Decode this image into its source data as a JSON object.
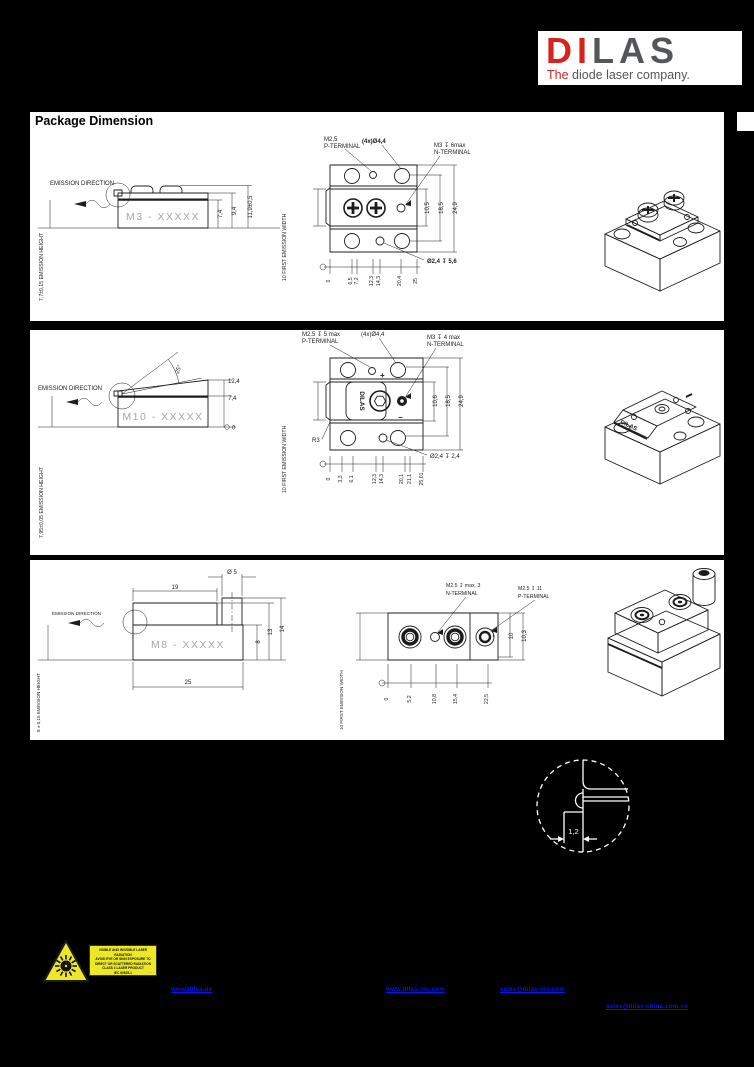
{
  "logo": {
    "di": "DI",
    "las": "LAS",
    "tagline_the": "The",
    "tagline_rest": " diode laser company."
  },
  "header": {
    "title": "Package Dimension"
  },
  "colors": {
    "brand_red": "#d8231d",
    "brand_gray": "#55565a",
    "link_blue": "#0018ea",
    "warning_yellow": "#ede827"
  },
  "panels": [
    {
      "side": {
        "emission_direction": "EMISSION DIRECTION",
        "model": "M3 - XXXXX",
        "emission_height_label": "7,7±0,15 EMISSION HEIGHT",
        "dims": [
          "7,4",
          "9,4",
          "11,9±0,5"
        ]
      },
      "top": {
        "p_terminal_line1": "M2,5",
        "p_terminal_line2": "P-TERMINAL",
        "holes_label": "(4x)Ø4,4",
        "n_terminal_line1": "M3 ↧ 6max",
        "n_terminal_line2": "N-TERMINAL",
        "counterbore": "Ø2,4 ↧ 5,6",
        "dims_right": [
          "10,5",
          "18,5",
          "24,9"
        ],
        "scale": [
          "0",
          "6,5",
          "7,2",
          "12,3",
          "14,3",
          "20,4",
          "25"
        ],
        "emission_width_label": "10 FIRST EMISSION WIDTH"
      }
    },
    {
      "side": {
        "emission_direction": "EMISSION DIRECTION",
        "model": "M10 - XXXXX",
        "emission_height_label": "7,95±0,05 EMISSION HEIGHT",
        "angle": "25°",
        "dims": [
          "12,4",
          "7,4",
          "0"
        ]
      },
      "top": {
        "p_terminal_line1": "M2.5 ↧ 5 max",
        "p_terminal_line2": "P-TERMINAL",
        "holes_label": "(4x)Ø4,4",
        "n_terminal_line1": "M3 ↧ 4 max",
        "n_terminal_line2": "N-TERMINAL",
        "radius_label": "R3",
        "counterbore": "Ø2,4 ↧ 2,4",
        "plus": "+",
        "minus": "−",
        "brand_mark": "DILAS",
        "dims_right": [
          "10,6",
          "18,5",
          "24,9"
        ],
        "scale": [
          "0",
          "3,3",
          "6,1",
          "12,3",
          "14,3",
          "20,1",
          "21,1",
          "25,01"
        ],
        "emission_width_label": "10 FIRST EMISSION WIDTH"
      },
      "iso": {
        "brand_mark": "DILAS"
      }
    },
    {
      "side": {
        "emission_direction": "EMISSION DIRECTION",
        "model": "M8 - XXXXX",
        "emission_height_label": "8 ± 0,15  EMISSION HEIGHT",
        "dim_length_top": "19",
        "dim_pin": "Ø 5",
        "dims_right": [
          "8",
          "13",
          "14"
        ],
        "dim_length": "25"
      },
      "top": {
        "n_terminal_line1": "M2.5 ↧ max. 3",
        "n_terminal_line2": "N-TERMINAL",
        "p_terminal_line1": "M2.5 ↧ 11",
        "p_terminal_line2": "P-TERMINAL",
        "dims_right": [
          "10",
          "10,3"
        ],
        "scale": [
          "0",
          "5,2",
          "10,8",
          "15,4",
          "22,5"
        ],
        "emission_width_label": "10 FIRST EMISSION WIDTH"
      }
    }
  ],
  "detail": {
    "dim": "1,2"
  },
  "warning": {
    "lines": [
      "VISIBLE AND INVISIBLE LASER RADIATION",
      "AVOID EYE OR SKIN EXPOSURE TO",
      "DIRECT OR SCATTERED RADIATION",
      "CLASS 4 LASER PRODUCT",
      "IEC 60825-1"
    ],
    "dots": "· · ·"
  },
  "footer": {
    "links": [
      "www.dilas.de",
      "www.dilas-inc.com",
      "sales@dilas-inc.com",
      "sales@dilas-china.com.cn"
    ]
  }
}
